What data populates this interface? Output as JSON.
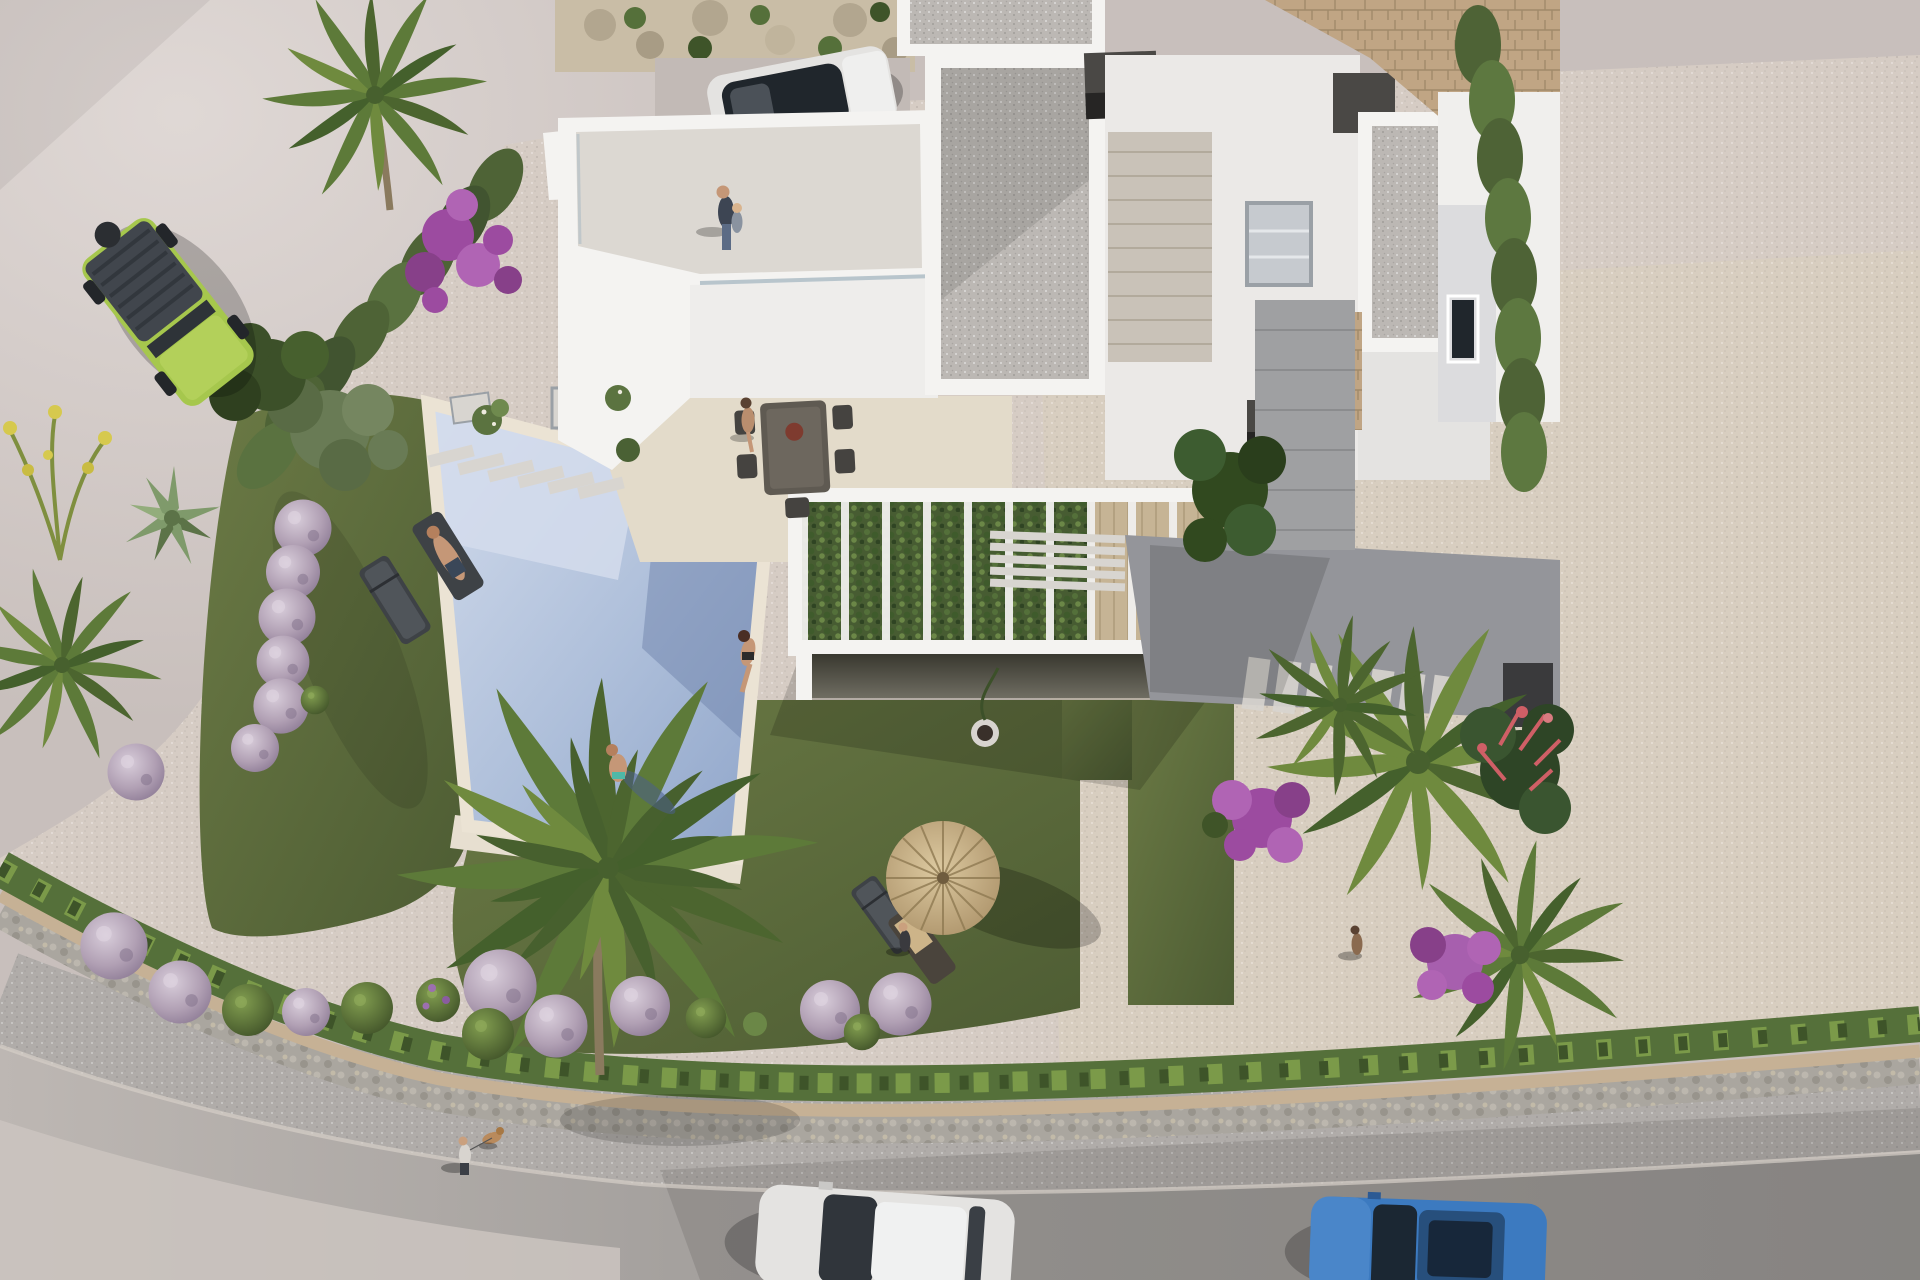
{
  "scene": {
    "type": "aerial-architectural-render",
    "description": "Bird's-eye 3D visualization of a modern flat-roof white villa with landscaped garden, swimming pool, pergola, street corner with cars and pedestrians",
    "people_count": 9,
    "dog_count": 1,
    "vehicles": [
      "green-offroad-jeep",
      "white-suv-parked",
      "white-car-on-road",
      "blue-car-on-road"
    ],
    "objects": [
      "modern-villa",
      "roof-terrace",
      "swimming-pool",
      "pergola-with-vines",
      "lawn",
      "gravel-garden",
      "straw-parasol",
      "sun-loungers",
      "outdoor-dining-set",
      "stone-boundary-wall",
      "cypress-hedge",
      "lavender-bushes",
      "palm-trees",
      "bougainvillea",
      "agave",
      "street",
      "sidewalk",
      "neighbor-villa",
      "natural-stone-wall"
    ]
  },
  "colors": {
    "pavement": "#c8bfbc",
    "pavement_light": "#d8d1ce",
    "road_asphalt": "#a19e9b",
    "sidewalk": "#b0aca9",
    "gravel_plot": "#d6ccc4",
    "gravel_warm": "#dbcfbe",
    "grass": "#5e6e3f",
    "grass_dark": "#46542f",
    "wall_white": "#f4f3f1",
    "wall_shade": "#dddddd",
    "roof_gravel": "#bcb8b4",
    "wood_deck": "#c9c2b8",
    "pool_shallow": "#d4dcec",
    "pool_deep": "#92a6ca",
    "pool_coping": "#ebe3d4",
    "terrace_cream": "#e3dbca",
    "hedge": "#55703a",
    "hedge_light": "#7b9a49",
    "cypress": "#4e6336",
    "lavender": "#b1a0b4",
    "bougainvillea": "#9c4ba0",
    "coral_plant": "#cf5f66",
    "palm_green": "#5d7a39",
    "stone_wall": "#c0a584",
    "wall_cap": "#c6b195",
    "straw": "#c7b189",
    "chimney": "#4a4845",
    "jeep_green": "#a6c74d",
    "car_white": "#e4e3e1",
    "car_blue": "#3c7ac0",
    "glass_dark": "#20262c",
    "skin": "#c59777",
    "dark_court": "#94959a",
    "steps": "#d8d5d0",
    "under_pergola": "#4a4a44",
    "door_brown": "#40291c"
  }
}
